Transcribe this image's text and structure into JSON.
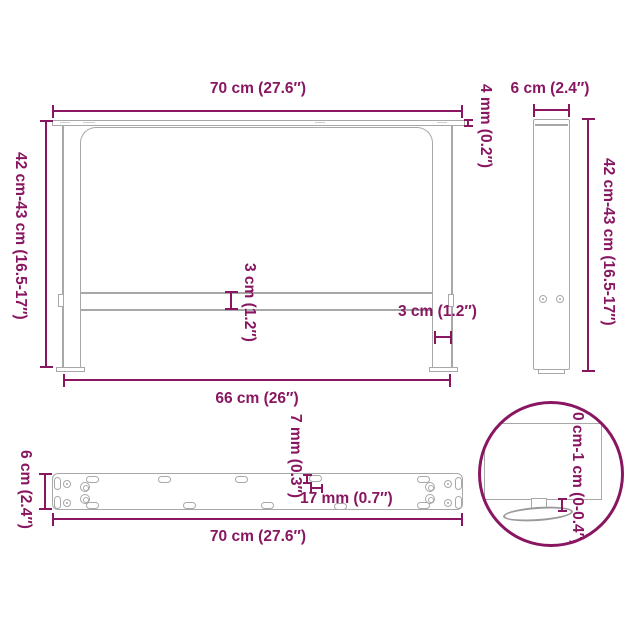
{
  "accent_color": "#881661",
  "drawing_line_color": "#a8a8a8",
  "front_view": {
    "top_width": "70 cm (27.6″)",
    "plate_thickness": "4 mm (0.2″)",
    "height": "42 cm-43 cm (16.5-17″)",
    "crossbar_thickness": "3 cm (1.2″)",
    "leg_width": "3 cm (1.2″)",
    "inner_width": "66 cm (26″)"
  },
  "side_view": {
    "depth": "6 cm (2.4″)",
    "height": "42 cm-43 cm (16.5-17″)"
  },
  "bar_view": {
    "depth": "6 cm (2.4″)",
    "hole_width": "7 mm (0.3″)",
    "hole_length": "17 mm (0.7″)",
    "length": "70 cm (27.6″)"
  },
  "detail_view": {
    "adjustable_height": "0 cm-1 cm (0-0.4″)"
  }
}
